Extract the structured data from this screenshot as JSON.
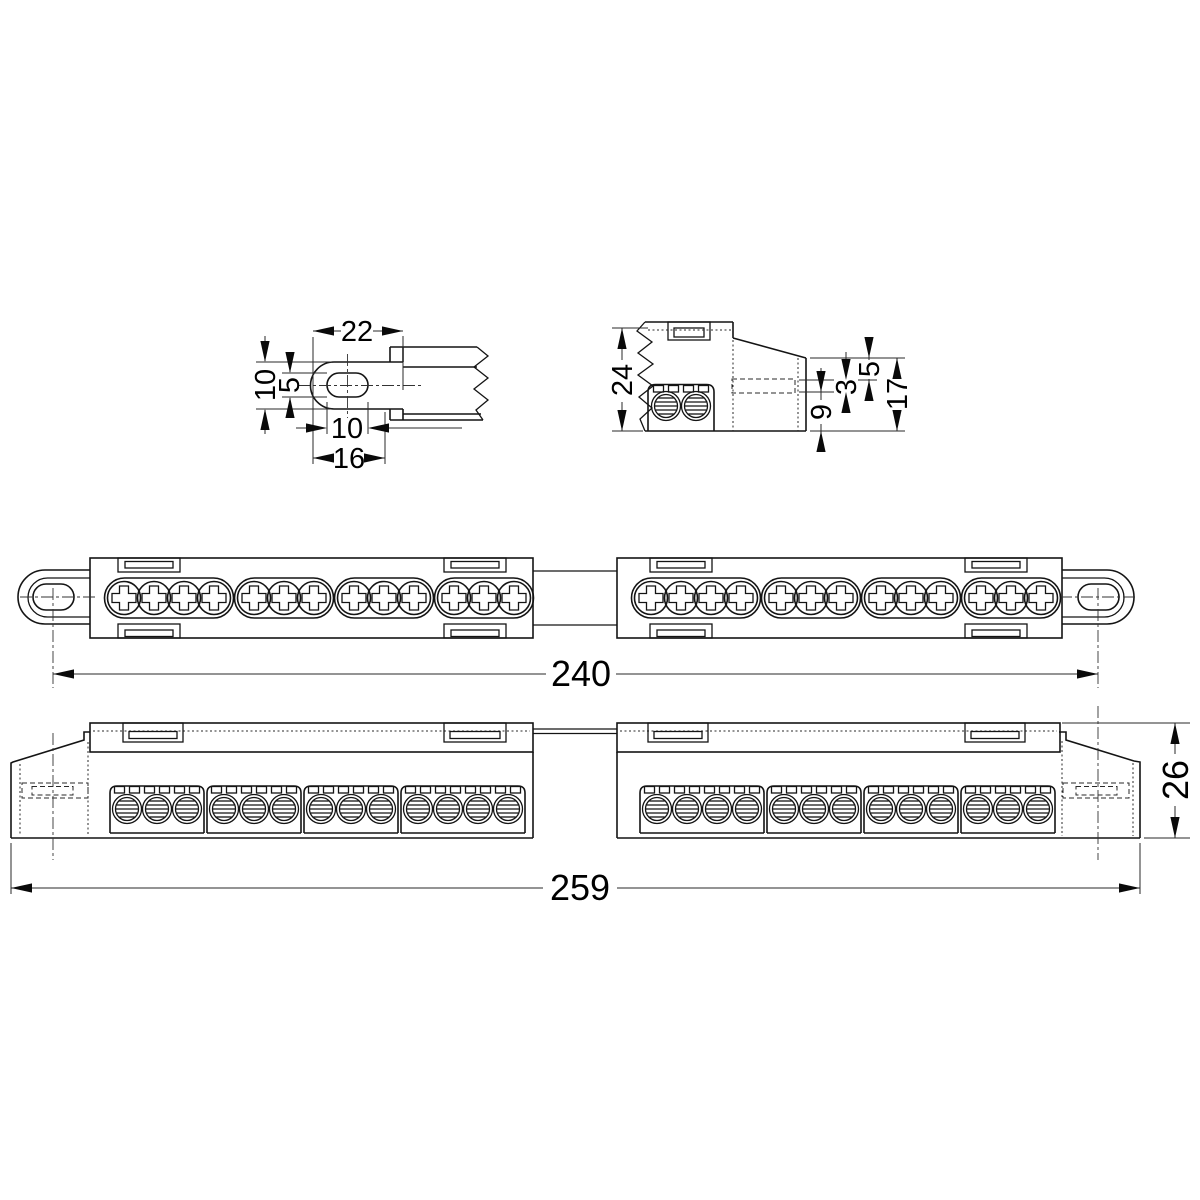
{
  "drawing": {
    "type": "technical dimension drawing",
    "subject": "screw terminal strip (busbar) with slotted end mounting lugs",
    "views": {
      "lug_detail": {
        "name": "mounting-lug detail",
        "dims": {
          "lug_to_body": "22",
          "lug_width": "10",
          "slot_width": "5",
          "slot_length": "10",
          "lug_length": "16"
        }
      },
      "end_detail": {
        "name": "end cross-section detail",
        "dims": {
          "overall_height": "24",
          "step_top": "5",
          "step_mid": "3",
          "step_bottom": "9",
          "end_height": "17"
        }
      },
      "top_view": {
        "name": "plan view",
        "dims": {
          "slot_centers_distance": "240"
        },
        "blocks": 2,
        "screw_terminals_per_block": 13,
        "screw_group_pattern": [
          4,
          3,
          3,
          3
        ]
      },
      "front_view": {
        "name": "front elevation",
        "dims": {
          "overall_length": "259",
          "overall_height": "26"
        },
        "wire_hole_groups_left": [
          3,
          3,
          3,
          4
        ],
        "wire_hole_groups_right": [
          4,
          3,
          3,
          3
        ]
      }
    }
  }
}
